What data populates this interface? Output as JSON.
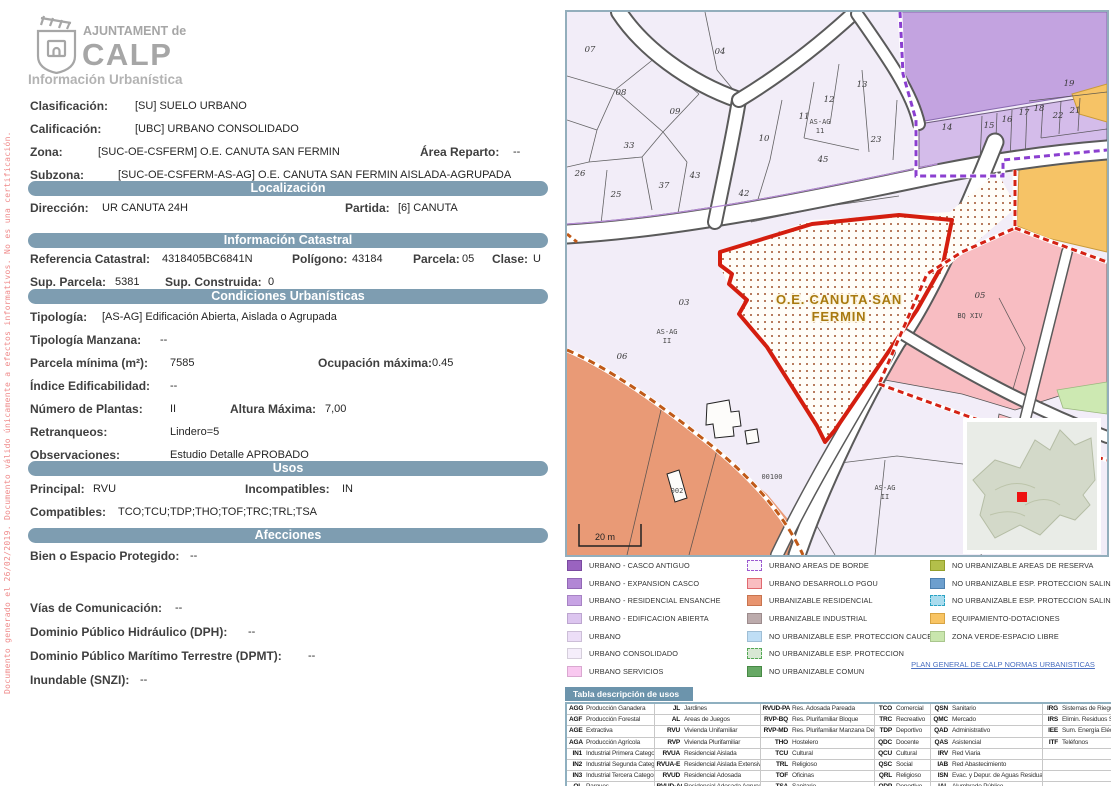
{
  "watermark": "Documento generado el 26/02/2019. Documento válido únicamente a efectos informativos. No es una certificación.",
  "logo": {
    "line1": "AJUNTAMENT de",
    "line2": "CALP",
    "subtitle": "Información Urbanística"
  },
  "doc": {
    "clasificacion": {
      "label": "Clasificación:",
      "value": "[SU] SUELO URBANO"
    },
    "calificacion": {
      "label": "Calificación:",
      "value": "[UBC] URBANO CONSOLIDADO"
    },
    "zona": {
      "label": "Zona:",
      "value": "[SUC-OE-CSFERM] O.E. CANUTA SAN FERMIN"
    },
    "area_reparto": {
      "label": "Área Reparto:",
      "value": "--"
    },
    "subzona": {
      "label": "Subzona:",
      "value": "[SUC-OE-CSFERM-AS-AG] O.E. CANUTA SAN FERMIN AISLADA-AGRUPADA"
    },
    "direccion": {
      "label": "Dirección:",
      "value": "UR CANUTA 24H"
    },
    "partida": {
      "label": "Partida:",
      "value": "[6] CANUTA"
    },
    "ref_catastral": {
      "label": "Referencia Catastral:",
      "value": "4318405BC6841N"
    },
    "poligono": {
      "label": "Polígono:",
      "value": "43184"
    },
    "parcela": {
      "label": "Parcela:",
      "value": "05"
    },
    "clase": {
      "label": "Clase:",
      "value": "U"
    },
    "sup_parcela": {
      "label": "Sup. Parcela:",
      "value": "5381"
    },
    "sup_construida": {
      "label": "Sup. Construida:",
      "value": "0"
    },
    "tipologia": {
      "label": "Tipología:",
      "value": "[AS-AG] Edificación Abierta, Aislada o Agrupada"
    },
    "tipologia_manzana": {
      "label": "Tipología Manzana:",
      "value": "--"
    },
    "parcela_minima": {
      "label": "Parcela mínima (m²):",
      "value": "7585"
    },
    "ocupacion_maxima": {
      "label": "Ocupación máxima:",
      "value": "0.45"
    },
    "indice_edificabilidad": {
      "label": "Índice Edificabilidad:",
      "value": "--"
    },
    "numero_plantas": {
      "label": "Número de Plantas:",
      "value": "II"
    },
    "altura_maxima": {
      "label": "Altura Máxima:",
      "value": "7,00"
    },
    "retranqueos": {
      "label": "Retranqueos:",
      "value": "Lindero=5"
    },
    "observaciones": {
      "label": "Observaciones:",
      "value": "Estudio Detalle APROBADO"
    },
    "principal": {
      "label": "Principal:",
      "value": "RVU"
    },
    "incompatibles": {
      "label": "Incompatibles:",
      "value": "IN"
    },
    "compatibles": {
      "label": "Compatibles:",
      "value": "TCO;TCU;TDP;THO;TOF;TRC;TRL;TSA"
    },
    "bien_protegido": {
      "label": "Bien o Espacio Protegido:",
      "value": "--"
    },
    "vias": {
      "label": "Vías de Comunicación:",
      "value": "--"
    },
    "dph": {
      "label": "Dominio Público Hidráulico (DPH):",
      "value": "--"
    },
    "dpmt": {
      "label": "Dominio Público Marítimo Terrestre (DPMT):",
      "value": "--"
    },
    "inundable": {
      "label": "Inundable (SNZI):",
      "value": "--"
    }
  },
  "sections": {
    "localizacion": "Localización",
    "catastral": "Información Catastral",
    "condiciones": "Condiciones Urbanísticas",
    "usos": "Usos",
    "afecciones": "Afecciones"
  },
  "map": {
    "zone_label_line1": "O.E. CANUTA SAN",
    "zone_label_line2": "FERMIN",
    "scale_label": "20 m",
    "labels": [
      {
        "t": "07",
        "x": 23,
        "y": 40
      },
      {
        "t": "04",
        "x": 153,
        "y": 42
      },
      {
        "t": "08",
        "x": 54,
        "y": 83
      },
      {
        "t": "09",
        "x": 108,
        "y": 102
      },
      {
        "t": "13",
        "x": 295,
        "y": 75
      },
      {
        "t": "12",
        "x": 262,
        "y": 90
      },
      {
        "t": "11",
        "x": 237,
        "y": 107
      },
      {
        "t": "10",
        "x": 197,
        "y": 129
      },
      {
        "t": "23",
        "x": 309,
        "y": 130
      },
      {
        "t": "45",
        "x": 256,
        "y": 150
      },
      {
        "t": "33",
        "x": 62,
        "y": 136
      },
      {
        "t": "26",
        "x": 13,
        "y": 164
      },
      {
        "t": "25",
        "x": 49,
        "y": 185
      },
      {
        "t": "37",
        "x": 97,
        "y": 176
      },
      {
        "t": "43",
        "x": 128,
        "y": 166
      },
      {
        "t": "42",
        "x": 177,
        "y": 184
      },
      {
        "t": "14",
        "x": 380,
        "y": 118
      },
      {
        "t": "15",
        "x": 422,
        "y": 116
      },
      {
        "t": "16",
        "x": 440,
        "y": 110
      },
      {
        "t": "17",
        "x": 457,
        "y": 103
      },
      {
        "t": "18",
        "x": 472,
        "y": 99
      },
      {
        "t": "19",
        "x": 502,
        "y": 74
      },
      {
        "t": "22",
        "x": 491,
        "y": 106
      },
      {
        "t": "21",
        "x": 508,
        "y": 101
      },
      {
        "t": "03",
        "x": 117,
        "y": 293
      },
      {
        "t": "06",
        "x": 55,
        "y": 347
      },
      {
        "t": "05",
        "x": 413,
        "y": 286
      },
      {
        "t": "AS-AG",
        "x": 253,
        "y": 112,
        "c": "amlbl"
      },
      {
        "t": "11",
        "x": 253,
        "y": 121,
        "c": "amlbl"
      },
      {
        "t": "AS-AG",
        "x": 100,
        "y": 322,
        "c": "amlbl"
      },
      {
        "t": "II",
        "x": 100,
        "y": 331,
        "c": "amlbl"
      },
      {
        "t": "AS-AG",
        "x": 318,
        "y": 478,
        "c": "amlbl"
      },
      {
        "t": "II",
        "x": 318,
        "y": 487,
        "c": "amlbl"
      },
      {
        "t": "BQ XIV",
        "x": 403,
        "y": 306,
        "c": "amlbl"
      },
      {
        "t": "002",
        "x": 110,
        "y": 481,
        "c": "amlbl"
      },
      {
        "t": "00100",
        "x": 205,
        "y": 467,
        "c": "amlbl"
      }
    ]
  },
  "legend": {
    "link": "PLAN GENERAL DE CALP NORMAS URBANISTICAS",
    "columns": [
      [
        {
          "label": "URBANO - CASCO ANTIGUO",
          "fill": "#9a63c0",
          "border": "#7a4aa0"
        },
        {
          "label": "URBANO - EXPANSION CASCO",
          "fill": "#b287d5",
          "border": "#9268b5"
        },
        {
          "label": "URBANO - RESIDENCIAL ENSANCHE",
          "fill": "#c7a3e4",
          "border": "#a783c4"
        },
        {
          "label": "URBANO - EDIFICACION ABIERTA",
          "fill": "#dcc5ef",
          "border": "#bca5cf"
        },
        {
          "label": "URBANO",
          "fill": "#ecdef7",
          "border": "#ccbed7"
        },
        {
          "label": "URBANO CONSOLIDADO",
          "fill": "#f5eefb",
          "border": "#d5cedb"
        },
        {
          "label": "URBANO SERVICIOS",
          "fill": "#f9c8f0",
          "border": "#d9a8d0"
        }
      ],
      [
        {
          "label": "URBANO AREAS DE BORDE",
          "fill": "#faf7fd",
          "border": "#9b59d0",
          "dash": true
        },
        {
          "label": "URBANO DESARROLLO PGOU",
          "fill": "#f9bdc1",
          "border": "#e06a70"
        },
        {
          "label": "URBANIZABLE RESIDENCIAL",
          "fill": "#e8946f",
          "border": "#c8744f"
        },
        {
          "label": "URBANIZABLE INDUSTRIAL",
          "fill": "#bcabac",
          "border": "#9c8b8c"
        },
        {
          "label": "NO URBANIZABLE ESP. PROTECCION CAUCES",
          "fill": "#bfdef5",
          "border": "#9fbed5"
        },
        {
          "label": "NO URBANIZABLE ESP. PROTECCION",
          "fill": "#d8e8d4",
          "border": "#55a855",
          "dash": true
        },
        {
          "label": "NO URBANIZABLE COMUN",
          "fill": "#67a965",
          "border": "#478945"
        }
      ],
      [
        {
          "label": "NO URBANIZABLE AREAS DE RESERVA",
          "fill": "#b3bf4a",
          "border": "#939f2a"
        },
        {
          "label": "NO URBANIZABLE ESP. PROTECCION SALINAS AGUA",
          "fill": "#6d9fce",
          "border": "#4d7fae"
        },
        {
          "label": "NO URBANIZABLE ESP. PROTECCION SALINAS",
          "fill": "#aadcee",
          "border": "#29a3c4",
          "dash": true
        },
        {
          "label": "EQUIPAMIENTO-DOTACIONES",
          "fill": "#f8c463",
          "border": "#d8a443"
        },
        {
          "label": "ZONA VERDE-ESPACIO LIBRE",
          "fill": "#c9e6ad",
          "border": "#a9c68d"
        }
      ]
    ]
  },
  "usos_table": {
    "title": "Tabla descripción de usos",
    "rows": [
      [
        [
          "AGG",
          "Producción Ganadera"
        ],
        [
          "JL",
          "Jardines"
        ],
        [
          "RVUD-PA",
          "Res. Adosada Pareada"
        ],
        [
          "TCO",
          "Comercial"
        ],
        [
          "QSN",
          "Sanitario"
        ],
        [
          "IRG",
          "Sistemas de Riego"
        ]
      ],
      [
        [
          "AGF",
          "Producción Forestal"
        ],
        [
          "AL",
          "Areas de Juegos"
        ],
        [
          "RVP-BQ",
          "Res. Plurifamiliar Bloque"
        ],
        [
          "TRC",
          "Recreativo"
        ],
        [
          "QMC",
          "Mercado"
        ],
        [
          "IRS",
          "Elimin. Residuos Sólidos"
        ]
      ],
      [
        [
          "AGE",
          "Extractiva"
        ],
        [
          "RVU",
          "Vivienda Unifamiliar"
        ],
        [
          "RVP-MD",
          "Res. Plurifamiliar Manzana Densa"
        ],
        [
          "TDP",
          "Deportivo"
        ],
        [
          "QAD",
          "Administrativo"
        ],
        [
          "IEE",
          "Sum. Energía Eléctrica"
        ]
      ],
      [
        [
          "AGA",
          "Producción Agrícola"
        ],
        [
          "RVP",
          "Vivienda Plurifamiliar"
        ],
        [
          "THO",
          "Hostelero"
        ],
        [
          "QDC",
          "Docente"
        ],
        [
          "QAS",
          "Asistencial"
        ],
        [
          "ITF",
          "Teléfonos"
        ]
      ],
      [
        [
          "IN1",
          "Industrial Primera Categoría"
        ],
        [
          "RVUA",
          "Residencial Aislada"
        ],
        [
          "TCU",
          "Cultural"
        ],
        [
          "QCU",
          "Cultural"
        ],
        [
          "IRV",
          "Red Viaria"
        ],
        [
          "",
          ""
        ]
      ],
      [
        [
          "IN2",
          "Industrial Segunda Categoría"
        ],
        [
          "RVUA-E",
          "Residencial Aislada Extensiva"
        ],
        [
          "TRL",
          "Religioso"
        ],
        [
          "QSC",
          "Social"
        ],
        [
          "IAB",
          "Red Abastecimiento"
        ],
        [
          "",
          ""
        ]
      ],
      [
        [
          "IN3",
          "Industrial Tercera Categoría"
        ],
        [
          "RVUD",
          "Residencial Adosada"
        ],
        [
          "TOF",
          "Oficinas"
        ],
        [
          "QRL",
          "Religioso"
        ],
        [
          "ISN",
          "Evac. y Depur. de Aguas Residuales"
        ],
        [
          "",
          ""
        ]
      ],
      [
        [
          "QL",
          "Parques"
        ],
        [
          "RVUD-AG",
          "Residencial Adosada Agrupada"
        ],
        [
          "TSA",
          "Sanitario"
        ],
        [
          "QDP",
          "Deportivo"
        ],
        [
          "IAL",
          "Alumbrado Público"
        ],
        [
          "",
          ""
        ]
      ]
    ]
  }
}
